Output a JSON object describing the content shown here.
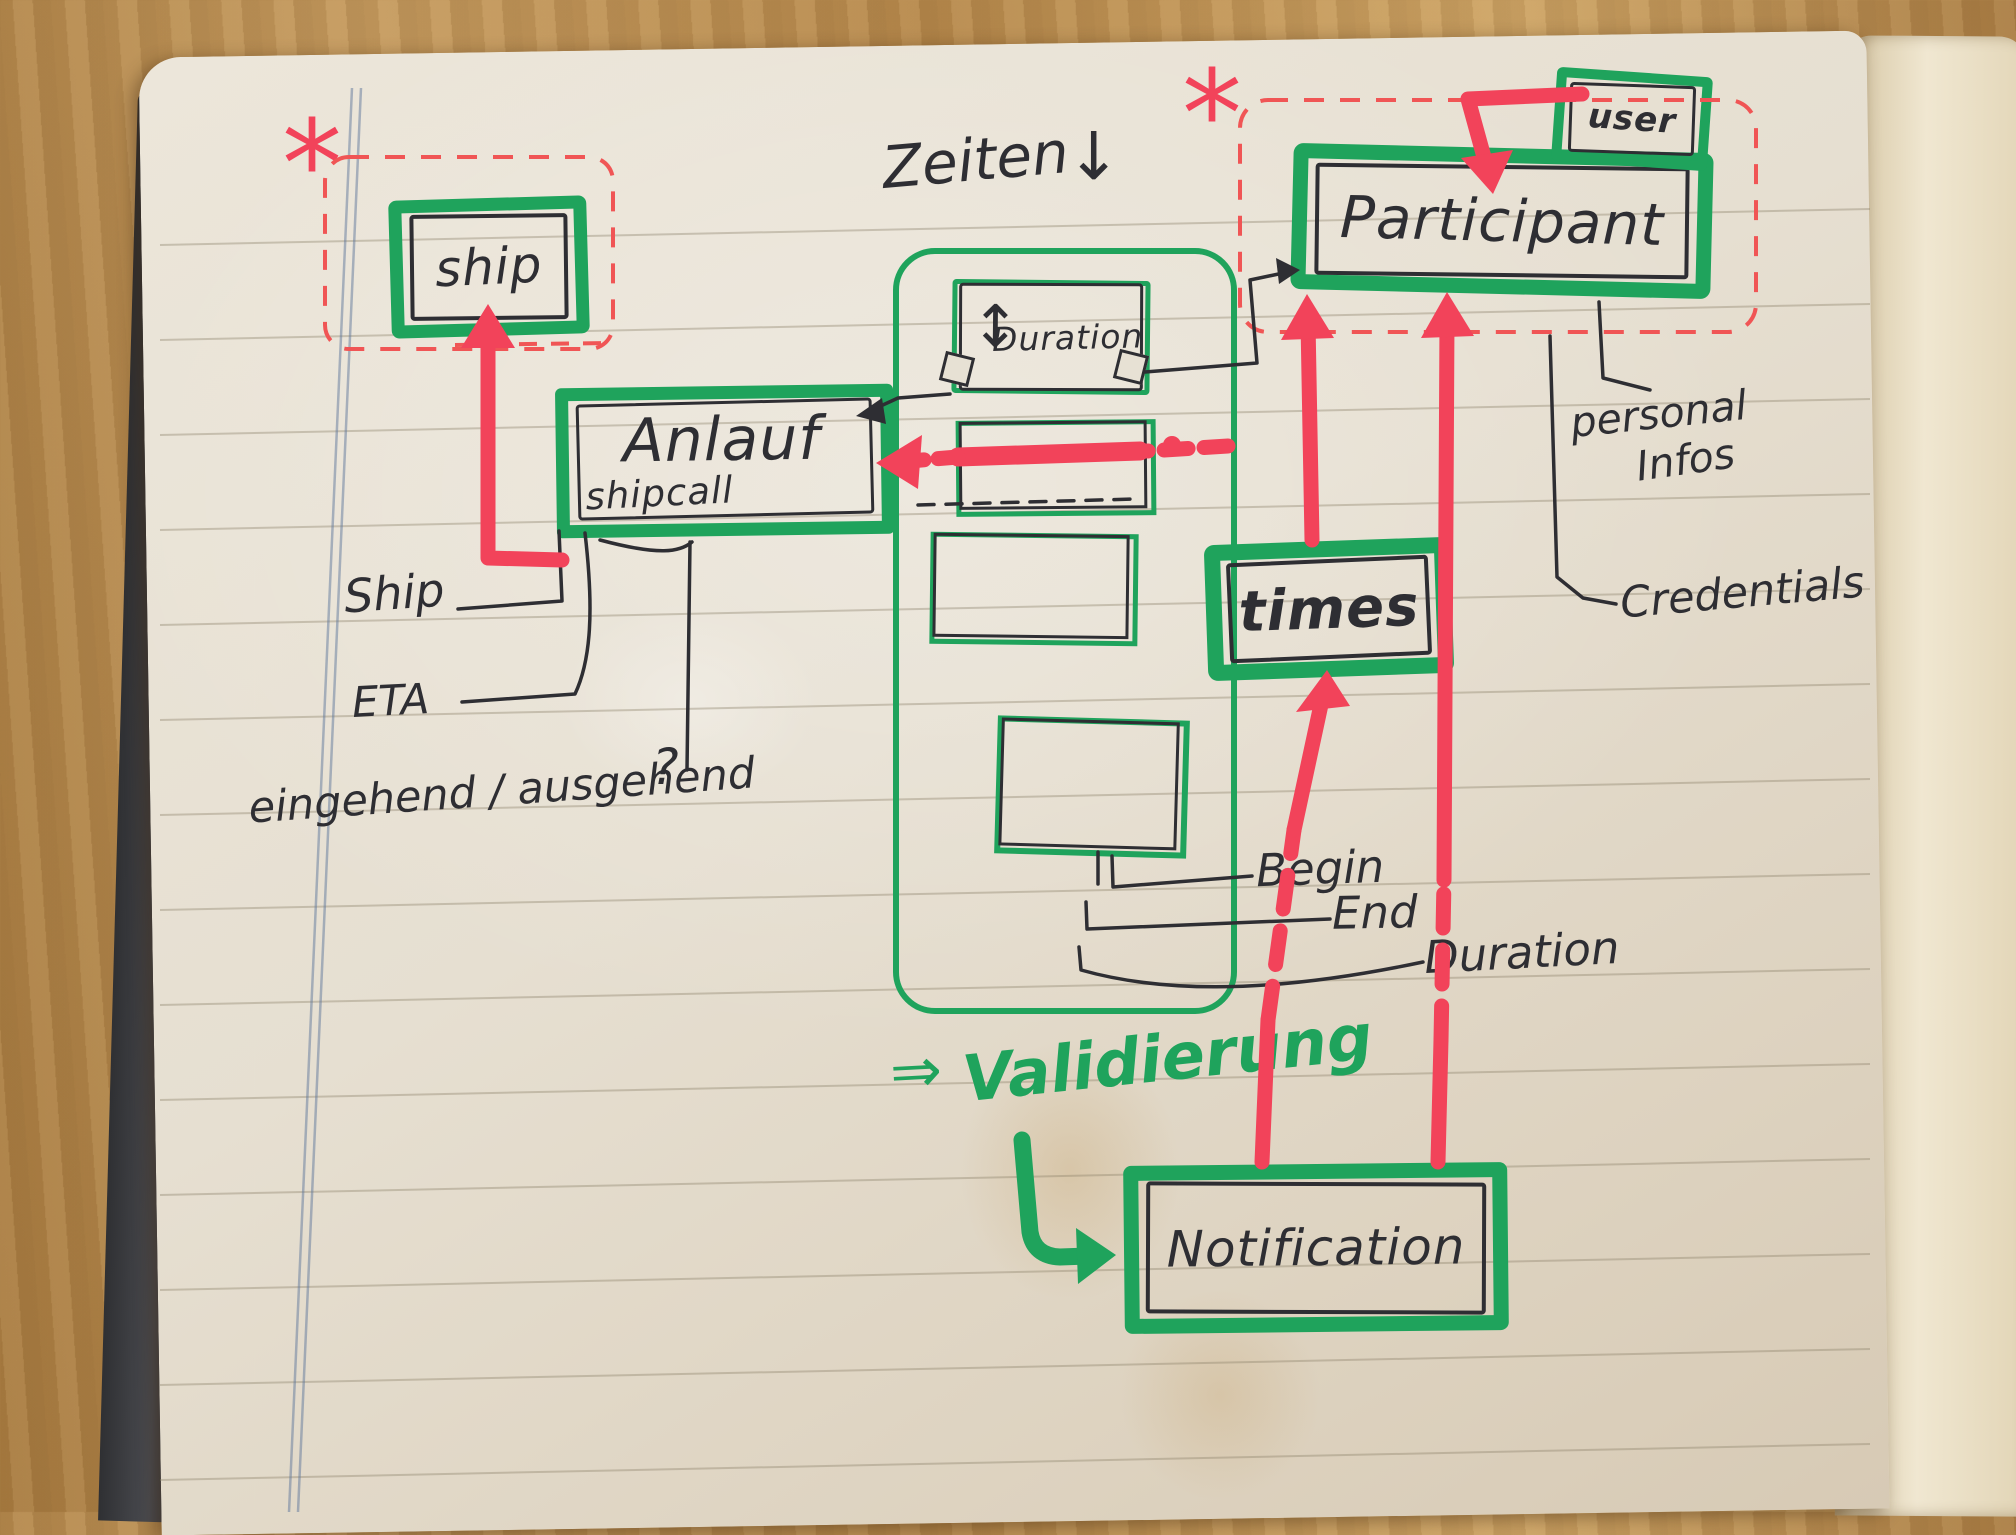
{
  "notebook": {
    "nodes": {
      "ship": "ship",
      "anlauf": "Anlauf",
      "anlauf_sub": "shipcall",
      "duration": "Duration",
      "duration_arrow": "↕",
      "times": "times",
      "participant": "Participant",
      "user": "user",
      "notification": "Notification"
    },
    "annotations": {
      "zeiten_label": "Zeiten",
      "zeiten_arrow": "↓",
      "asterisk_ship": "*",
      "asterisk_participant": "*",
      "validierung_arrow": "⇒",
      "validierung_label": "Validierung"
    },
    "attributes": {
      "ship_ref": "Ship",
      "eta": "ETA",
      "in_out": "eingehend / ausgehend",
      "question": "?",
      "begin": "Begin",
      "end": "End",
      "duration": "Duration",
      "personal_line1": "personal",
      "personal_line2": "Infos",
      "credentials": "Credentials"
    },
    "colors": {
      "marker_green": "#1fa35c",
      "marker_red": "#f2435a",
      "pen_black": "#2e2e33",
      "page": "#e7e1d4"
    }
  }
}
